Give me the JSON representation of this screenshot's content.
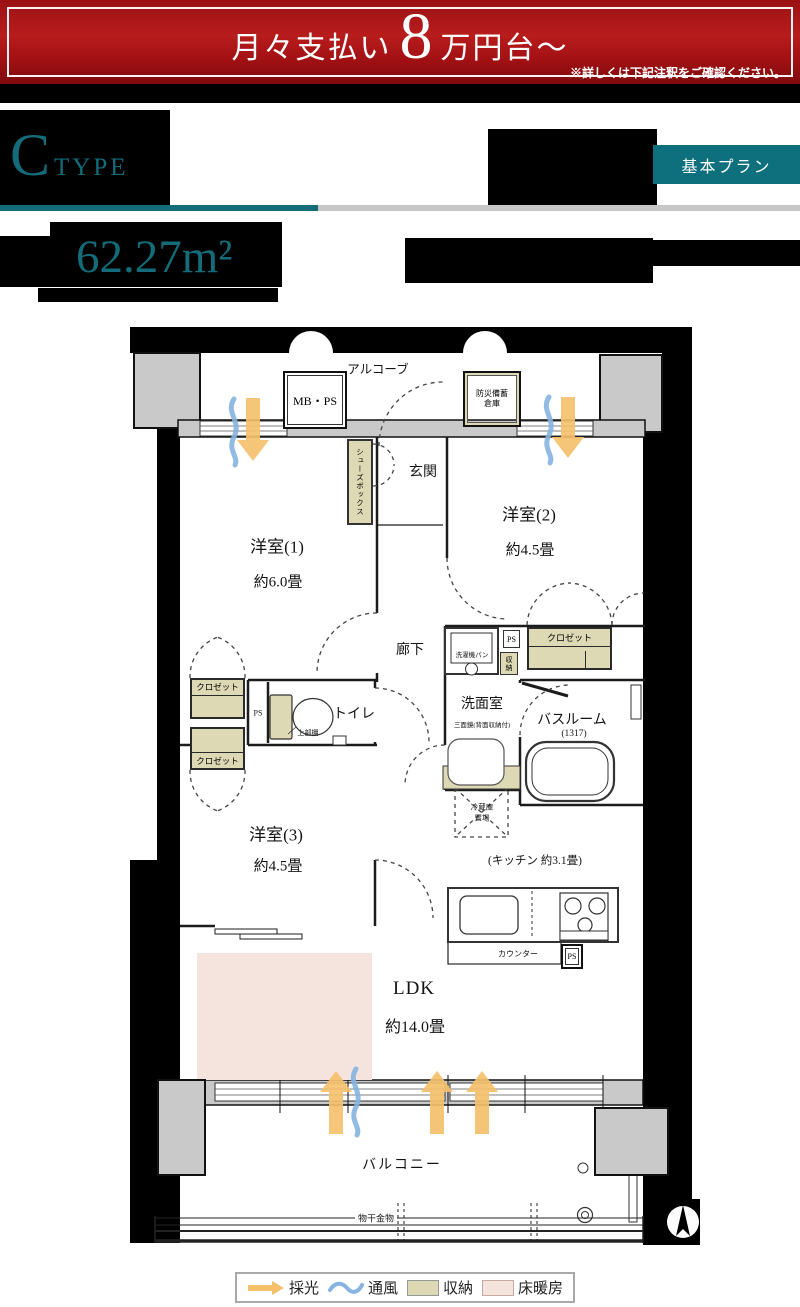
{
  "colors": {
    "teal": "#136c7a",
    "banner_red": "#b81c1c",
    "beige": "#ded9b5",
    "pink_floor_heating": "#f5e3de",
    "orange_light": "#f4c06c",
    "blue_wind": "#85b4e0",
    "wall_gray": "#c9c9c9"
  },
  "banner": {
    "prefix": "月々支払い",
    "amount": "8",
    "suffix": "万円台〜",
    "note": "※詳しくは下記注釈をご確認ください。"
  },
  "header": {
    "type_letter": "C",
    "type_word": "TYPE",
    "plan_badge": "基本プラン",
    "area": "62.27m²"
  },
  "fp": {
    "alcove": "アルコーブ",
    "mbps": "MB・PS",
    "bousai1": "防災備蓄",
    "bousai2": "倉庫",
    "genkan": "玄関",
    "shoes": "シューズボックス",
    "room1": "洋室(1)",
    "room1_size": "約6.0畳",
    "room2": "洋室(2)",
    "room2_size": "約4.5畳",
    "room3": "洋室(3)",
    "room3_size": "約4.5畳",
    "hall": "廊下",
    "closet": "クロゼット",
    "ps": "PS",
    "shuno": "収納",
    "washer": "洗濯機パン",
    "senmen": "洗面室",
    "mirror": "三面鏡(背面収納付)",
    "bath": "バスルーム",
    "bath_size": "(1317)",
    "toilet": "トイレ",
    "shelf": "上部棚",
    "fridge1": "冷蔵庫",
    "fridge2": "置場",
    "kitchen": "(キッチン 約3.1畳)",
    "counter": "カウンター",
    "ldk": "LDK",
    "ldk_size": "約14.0畳",
    "balcony": "バルコニー",
    "monohoshi": "物干金物"
  },
  "legend": {
    "saikou": "採光",
    "tsufu": "通風",
    "shuno": "収納",
    "yukadan": "床暖房"
  }
}
